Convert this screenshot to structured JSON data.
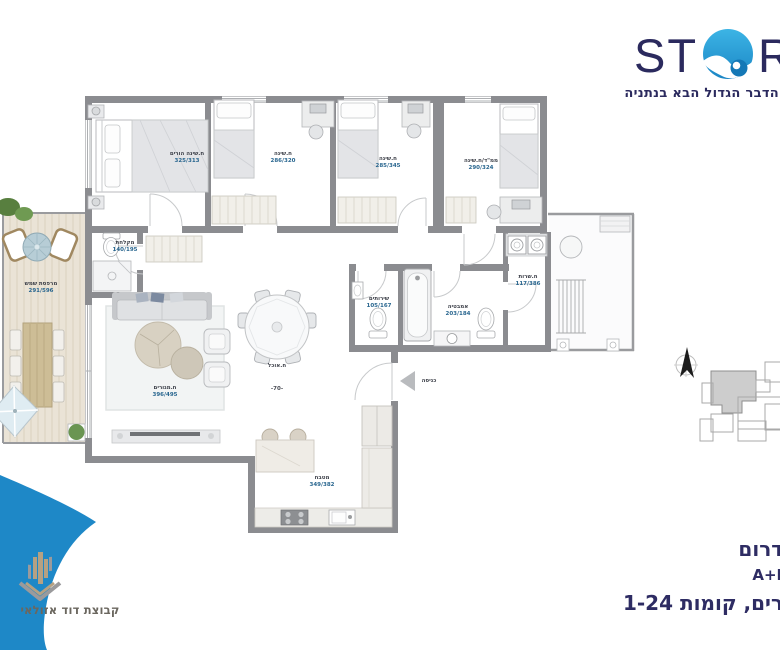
{
  "brand": {
    "prefix": "ST",
    "suffix": "R",
    "tagline": "הדבר הגדול הבא בנתניה",
    "navy": "#2b2a5e",
    "wave_blue": "#2aa7dd"
  },
  "plan": {
    "rooms": [
      {
        "name": "ח.שינה הורים",
        "dims": "325/313"
      },
      {
        "name": "ח.שינה",
        "dims": "286/320"
      },
      {
        "name": "ח.שינה",
        "dims": "285/345"
      },
      {
        "name": "ממ\"ד/ח.שינה",
        "dims": "290/324"
      },
      {
        "name": "מקלחת",
        "dims": "140/195"
      },
      {
        "name": "מרפסת שמש",
        "dims": "291/596"
      },
      {
        "name": "ח.מגורים",
        "dims": "396/495"
      },
      {
        "name": "ח.אוכל",
        "dims": "-70-"
      },
      {
        "name": "שירותים",
        "dims": "105/167"
      },
      {
        "name": "אמבטיה",
        "dims": "203/184"
      },
      {
        "name": "ח.שרות",
        "dims": "117/386"
      },
      {
        "name": "מטבח",
        "dims": "349/382"
      },
      {
        "name": "כניסה",
        "dims": ""
      }
    ],
    "wall_color": "#8b8c90",
    "deck_color": "#eae3d6",
    "key_plan_unit_fill": "#cdcdcd"
  },
  "footer": {
    "line1": "דרום",
    "line2": "A+B",
    "line3": "רים, קומות 1-24"
  },
  "developer": {
    "name": "קבוצת דוד אזולאי",
    "gold": "#b5a183",
    "crescent_blue": "#1e88c7"
  }
}
